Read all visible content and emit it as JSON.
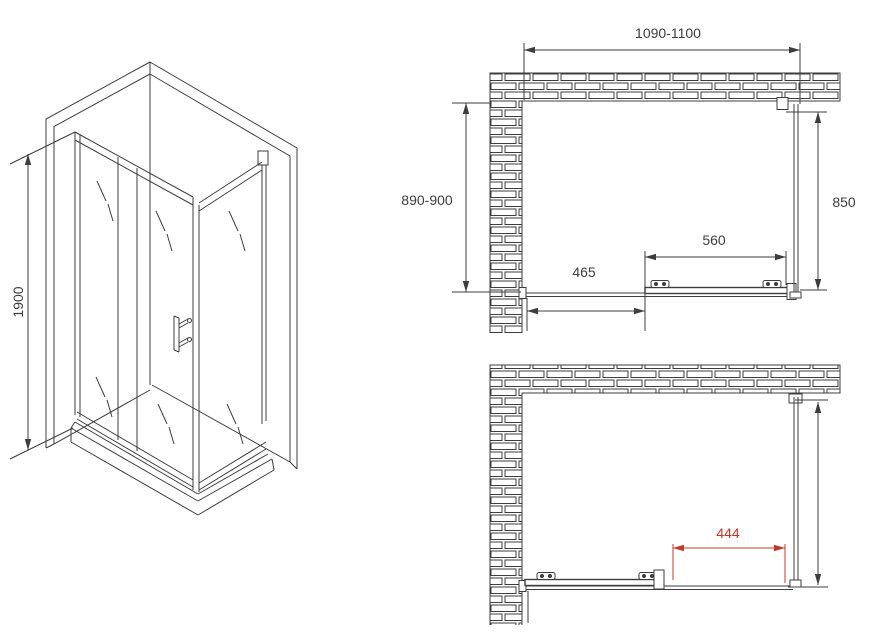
{
  "colors": {
    "line": "#3d3d3d",
    "accent": "#c0392b",
    "bg": "#ffffff"
  },
  "isometric_view": {
    "height_label": "1900"
  },
  "plan_closed": {
    "overall_width_label": "1090-1100",
    "wall_depth_label": "890-900",
    "side_panel_label": "850",
    "sliding_door_label": "560",
    "fixed_panel_label": "465"
  },
  "plan_open": {
    "opening_width_label": "444"
  }
}
